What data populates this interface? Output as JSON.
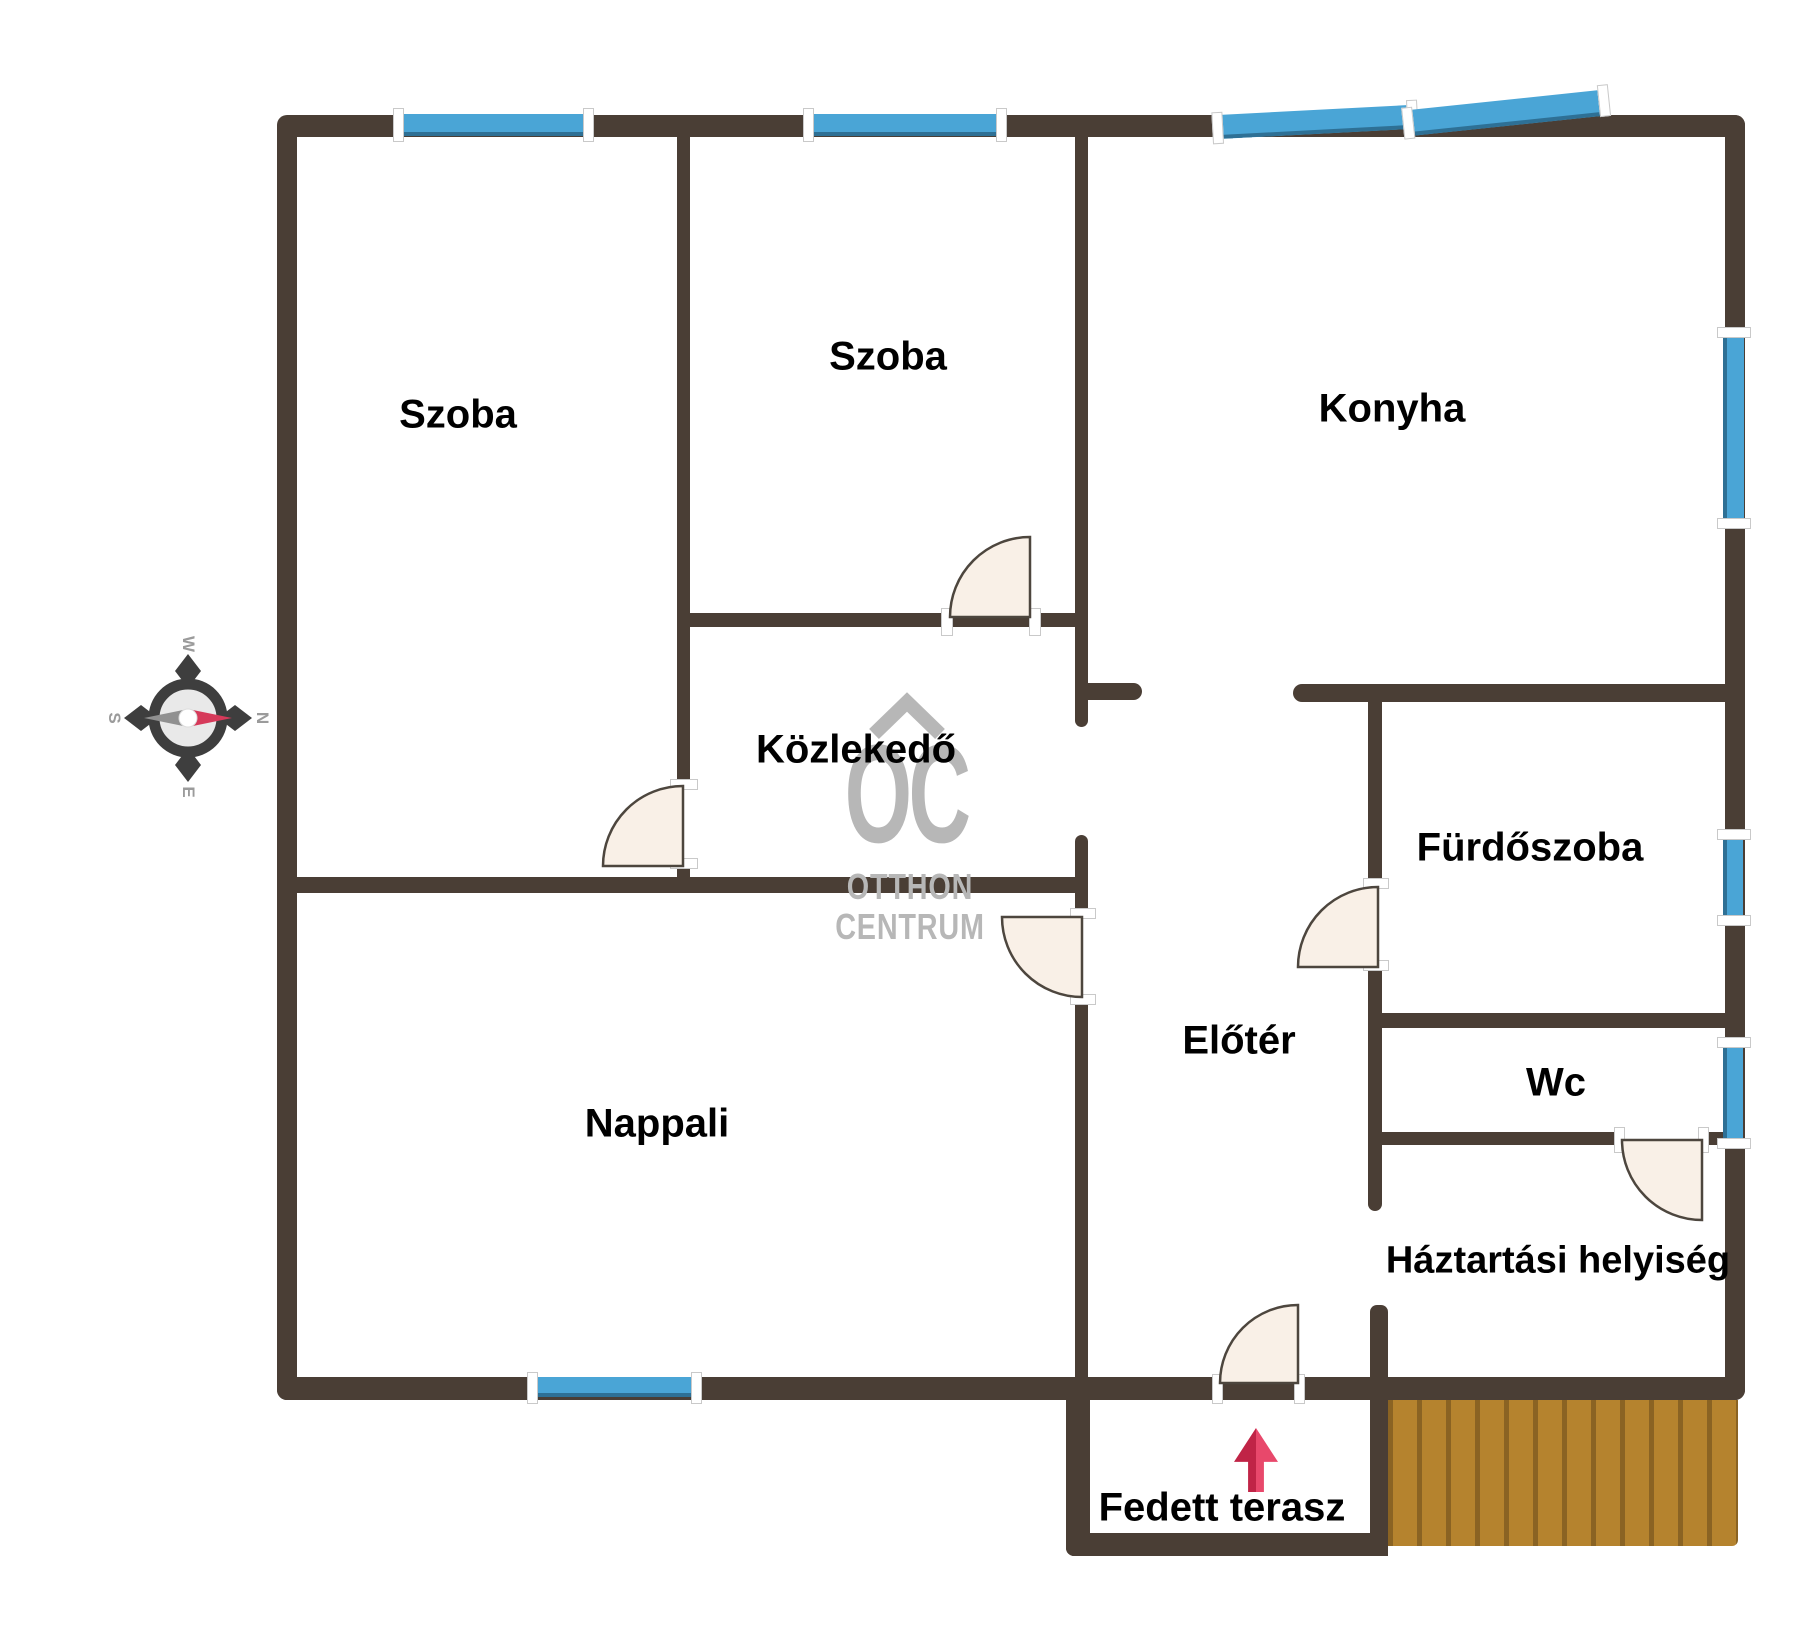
{
  "colors": {
    "background": "#ffffff",
    "wall": "#4a3e35",
    "window": "#4aa5d6",
    "window_edge": "#2e7095",
    "door_fill": "#f9f0e7",
    "door_stroke": "#4d463e",
    "jamb": "#ffffff",
    "deck": "#b5832e",
    "deck_line": "#8a6323",
    "arrow_dark": "#c02446",
    "arrow_light": "#e8486b",
    "watermark": "#b7b7b7",
    "label": "#000000",
    "compass_ring": "#3e3e3e",
    "compass_face": "#e9e9e9",
    "compass_letter": "#9b9b9b",
    "needle_red": "#d63a5a",
    "needle_gray": "#909090"
  },
  "rooms": {
    "szoba1": "Szoba",
    "szoba2": "Szoba",
    "konyha": "Konyha",
    "kozlekedo": "Közlekedő",
    "nappali": "Nappali",
    "eloter": "Előtér",
    "furdoszoba": "Fürdőszoba",
    "wc": "Wc",
    "haztartasi": "Háztartási helyiség",
    "terasz": "Fedett terasz"
  },
  "watermark": {
    "monogram": "OC",
    "line1": "OTTHON",
    "line2": "CENTRUM"
  },
  "compass": {
    "west": "W",
    "south": "S",
    "north": "N",
    "east": "E"
  }
}
